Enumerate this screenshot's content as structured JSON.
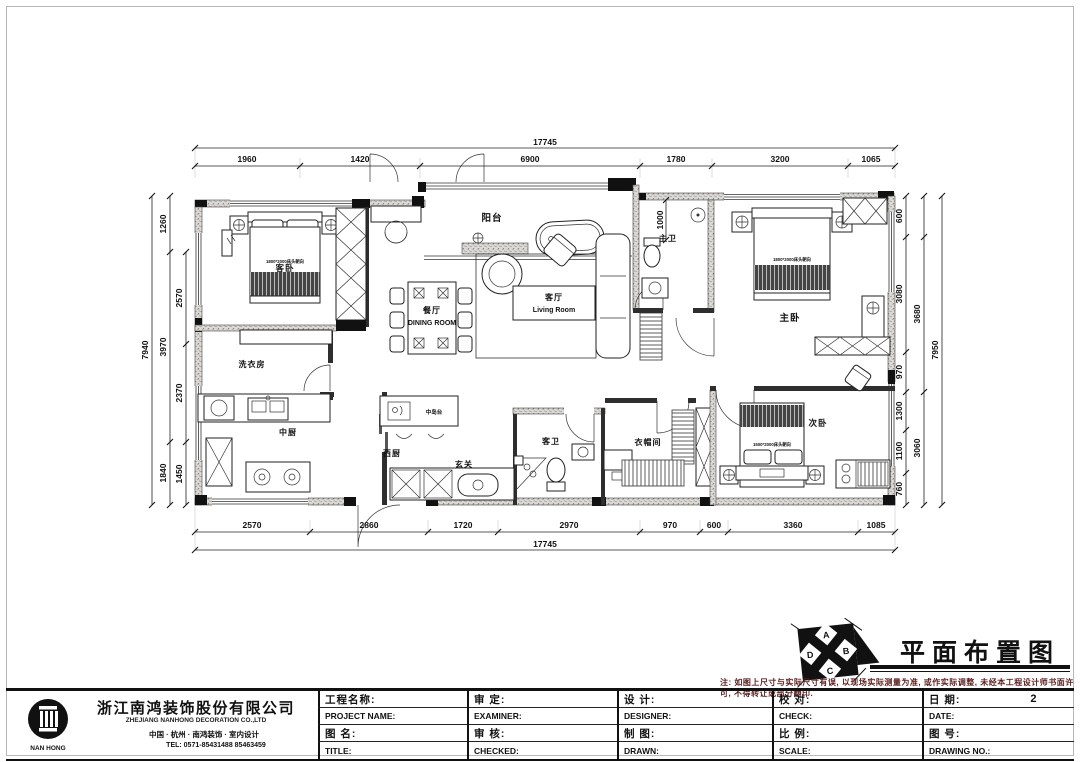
{
  "sheet": {
    "drawing_title": "平面布置图",
    "note": "注: 如图上尺寸与实际尺寸有误, 以现场实际测量为准, 或作实际调整, 未经本工程设计师书面许可, 不得转让或部分翻印.",
    "compass": {
      "letters": [
        "A",
        "B",
        "C",
        "D"
      ]
    }
  },
  "plan": {
    "rooms": {
      "balcony": "阳台",
      "guest_bedroom": "客卧",
      "guest_bed_note": "1800*2000床头朝向",
      "dining_cn": "餐厅",
      "dining_en": "DINING ROOM",
      "living_cn": "客厅",
      "living_en": "Living Room",
      "master_bath": "主卫",
      "master_bedroom": "主卧",
      "master_bed_note": "1800*2000床头朝向",
      "laundry": "洗衣房",
      "chinese_kitchen": "中厨",
      "western_kitchen": "西厨",
      "island": "中岛台",
      "foyer": "玄关",
      "guest_bath": "客卫",
      "cloakroom": "衣帽间",
      "second_bedroom": "次卧",
      "second_bed_note": "1500*2000床头朝向"
    },
    "dims": {
      "top_total": "17745",
      "top": [
        "1960",
        "1420",
        "6900",
        "1780",
        "3200",
        "1065"
      ],
      "bottom": [
        "2570",
        "2860",
        "1720",
        "2970",
        "970",
        "600",
        "3360",
        "1085"
      ],
      "bottom_total": "17745",
      "left_outer": "7940",
      "left_mid": [
        "1260",
        "3970",
        "1840"
      ],
      "left_inner": [
        "2570",
        "2370",
        "1450"
      ],
      "right_outer": "7950",
      "right_mid": [
        "3680",
        "3060"
      ],
      "right_inner": [
        "600",
        "3080",
        "970",
        "1300",
        "1100",
        "760"
      ],
      "bath": "1000"
    }
  },
  "footer": {
    "company": {
      "logo_text": "NAN HONG",
      "name_cn": "浙江南鸿装饰股份有限公司",
      "name_en": "ZHEJIANG NANHONG DECORATION CO.,LTD",
      "line3": "中国 · 杭州 · 南鸿装饰 · 室内设计",
      "tel": "TEL: 0571-85431488  85463459"
    },
    "fields": {
      "row1": [
        "工程名称:",
        "审  定:",
        "设  计:",
        "校  对:",
        "日  期:"
      ],
      "row2": [
        "PROJECT NAME:",
        "EXAMINER:",
        "DESIGNER:",
        "CHECK:",
        "DATE:"
      ],
      "row3": [
        "图  名:",
        "审  核:",
        "制  图:",
        "比  例:",
        "图  号:"
      ],
      "row4": [
        "TITLE:",
        "CHECKED:",
        "DRAWN:",
        "SCALE:",
        "DRAWING NO.:"
      ],
      "date_value": "2"
    }
  }
}
